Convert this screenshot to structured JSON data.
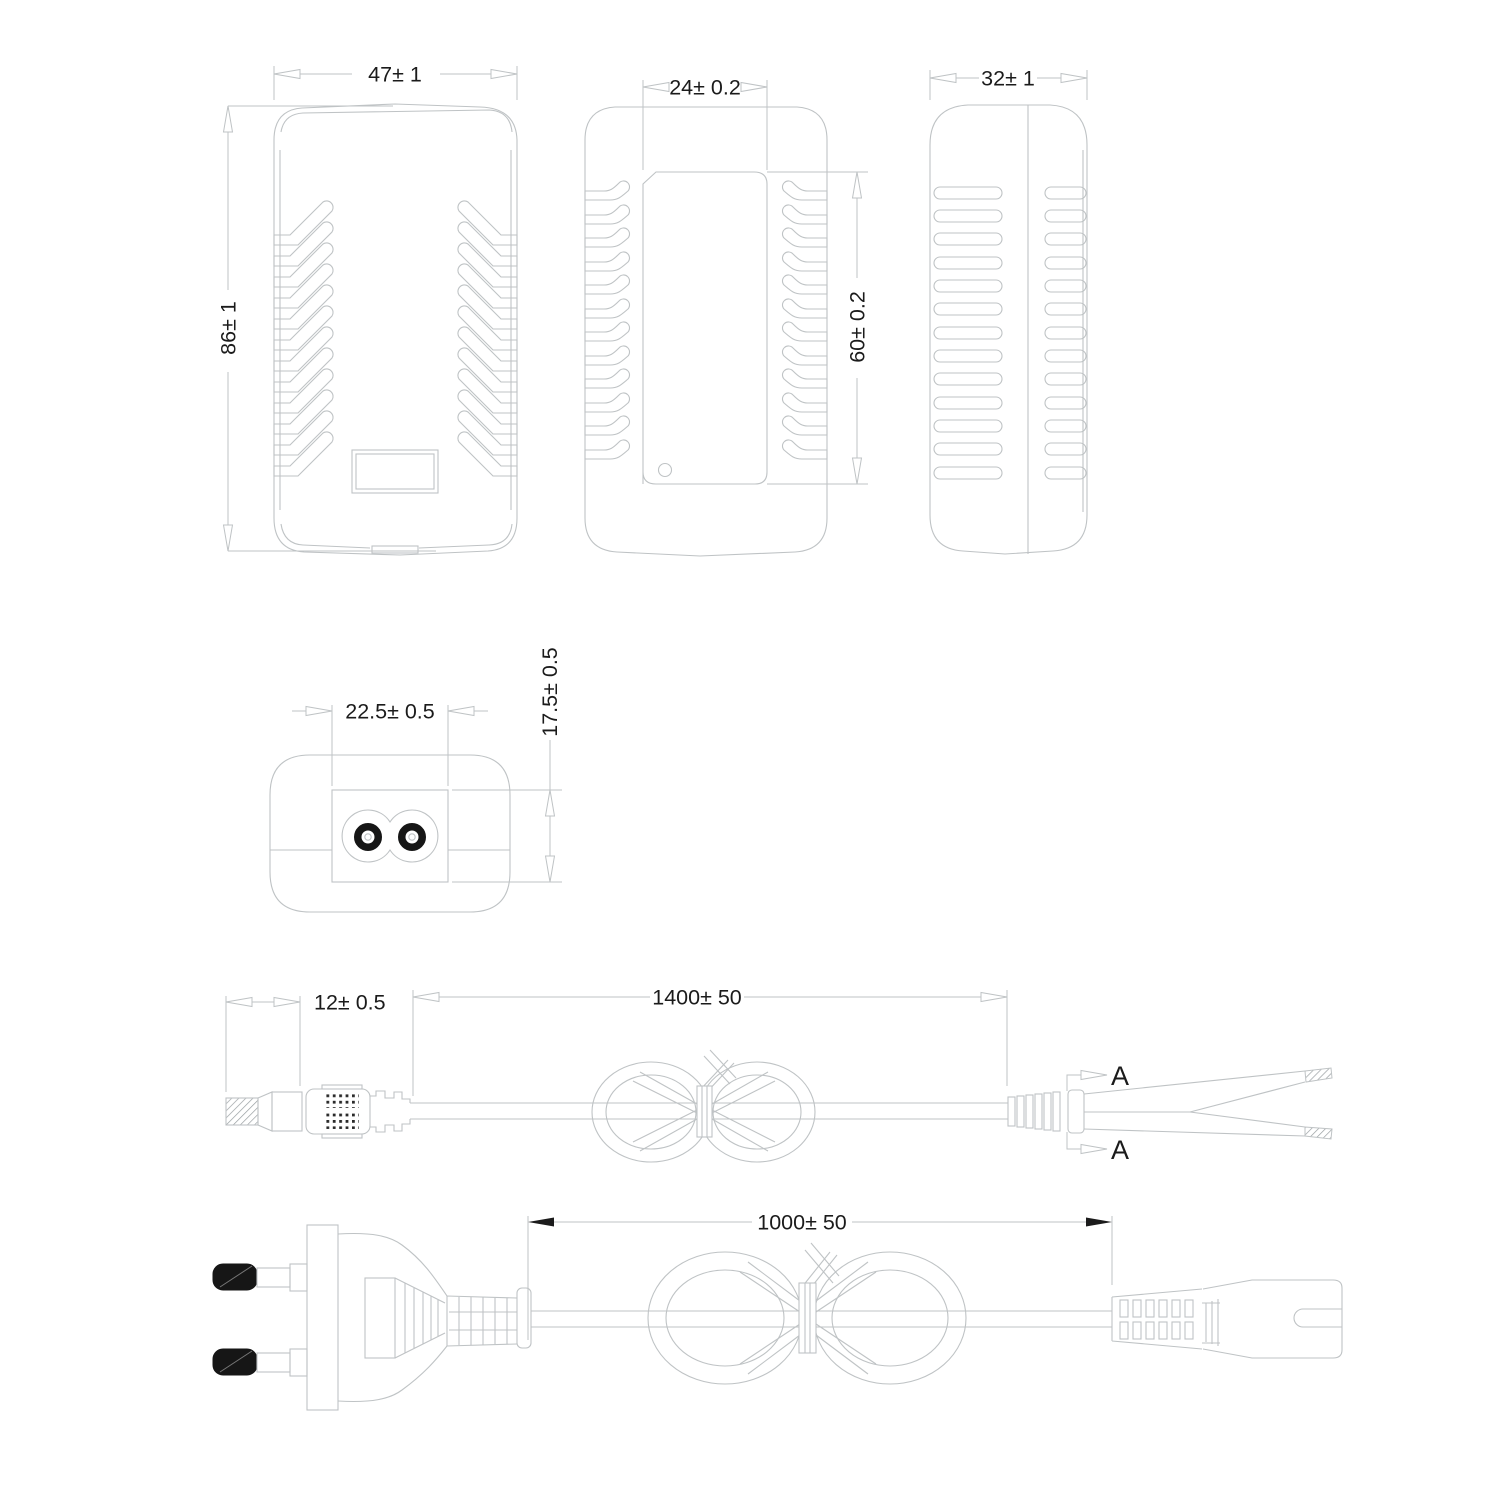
{
  "colors": {
    "line": "#bfc3c5",
    "text": "#1b1b1b",
    "pin_fill": "#161616"
  },
  "views": {
    "front": {
      "dim_width": "47± 1",
      "dim_height": "86± 1"
    },
    "inner": {
      "dim_width": "24± 0.2",
      "dim_height": "60± 0.2"
    },
    "side": {
      "dim_width": "32± 1"
    },
    "bottom": {
      "dim_width": "22.5± 0.5",
      "dim_height": "17.5± 0.5"
    },
    "dc_cable": {
      "dim_plug": "12± 0.5",
      "dim_length": "1400± 50",
      "section_top": "A",
      "section_bottom": "A"
    },
    "ac_cord": {
      "dim_length": "1000± 50"
    }
  }
}
